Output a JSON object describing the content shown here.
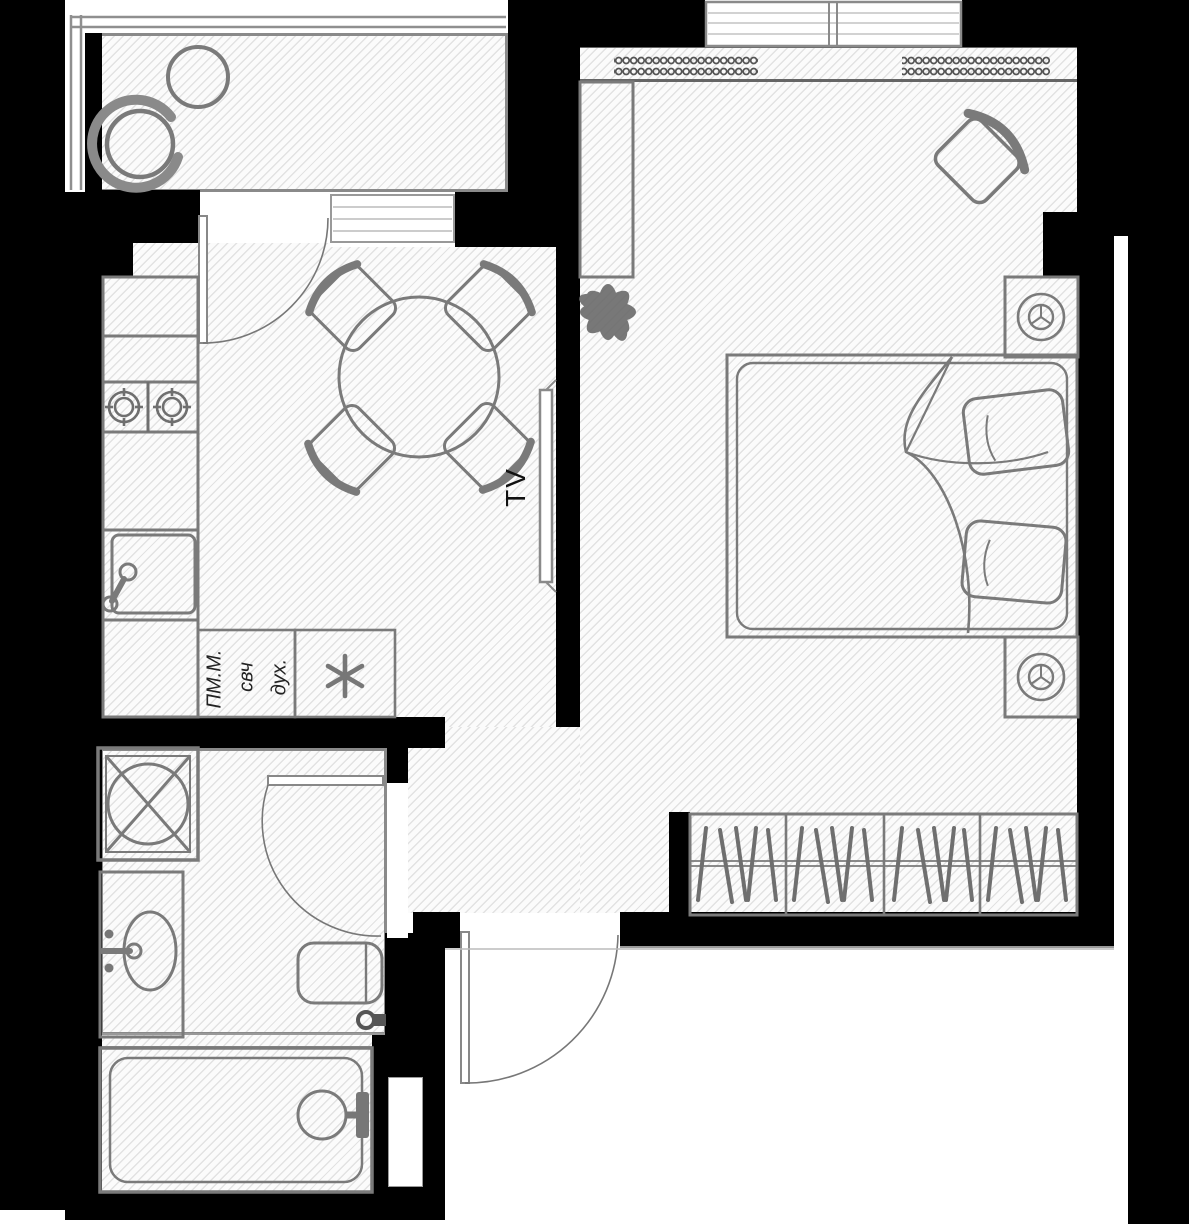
{
  "title": "studio-apartment-floor-plan",
  "colors": {
    "wall": "#000000",
    "furniture_line": "#7a7a7a",
    "dark_line": "#555555",
    "hatch_line": "#e2e2e2",
    "text": "#1c1c1c",
    "background": "#ffffff"
  },
  "labels": {
    "tv": "TV",
    "kitchen_appliance_col_left": "ПМ.М.",
    "kitchen_appliance_col_mid": "свч",
    "kitchen_appliance_col_right": "дух.",
    "fridge_mark": "*"
  },
  "rooms": [
    "balcony",
    "kitchen-living-room",
    "bedroom",
    "hallway",
    "bathroom",
    "bathtub-room"
  ],
  "furniture_icons": [
    "balcony-table-icon",
    "balcony-chair-icon",
    "kitchen-counter-icon",
    "hob-burners-icon",
    "kitchen-sink-icon",
    "appliance-cabinet-icon",
    "fridge-asterisk-icon",
    "dining-table-icon",
    "dining-chair-icon",
    "tv-icon",
    "plant-icon",
    "wardrobe-column-icon",
    "armchair-icon",
    "double-bed-icon",
    "pillow-icon",
    "nightstand-lamp-icon",
    "closet-hangers-icon",
    "radiator-coil-icon",
    "window-icon",
    "door-swing-icon",
    "shower-cabin-icon",
    "bathroom-sink-icon",
    "toilet-icon",
    "bathtub-icon",
    "faucet-icon"
  ]
}
